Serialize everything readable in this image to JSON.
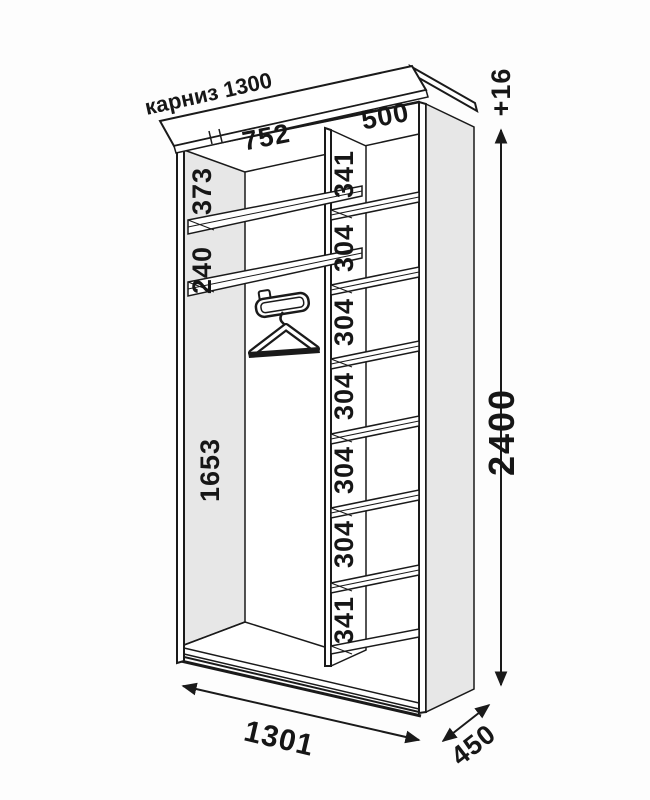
{
  "diagram": {
    "cornice_label": "карниз 1300",
    "top_widths": {
      "left_section": "752",
      "right_section": "500"
    },
    "left_column_sections": [
      "373",
      "240",
      "1653"
    ],
    "right_column_sections": [
      "341",
      "304",
      "304",
      "304",
      "304",
      "304",
      "341"
    ],
    "dimensions": {
      "total_height": "2400",
      "cornice_extra_height": "+16",
      "total_width": "1301",
      "depth": "450"
    },
    "colors": {
      "panel_gray": "#e7e7e7",
      "line": "#1a1a1a",
      "background": "#fdfdfd"
    }
  }
}
